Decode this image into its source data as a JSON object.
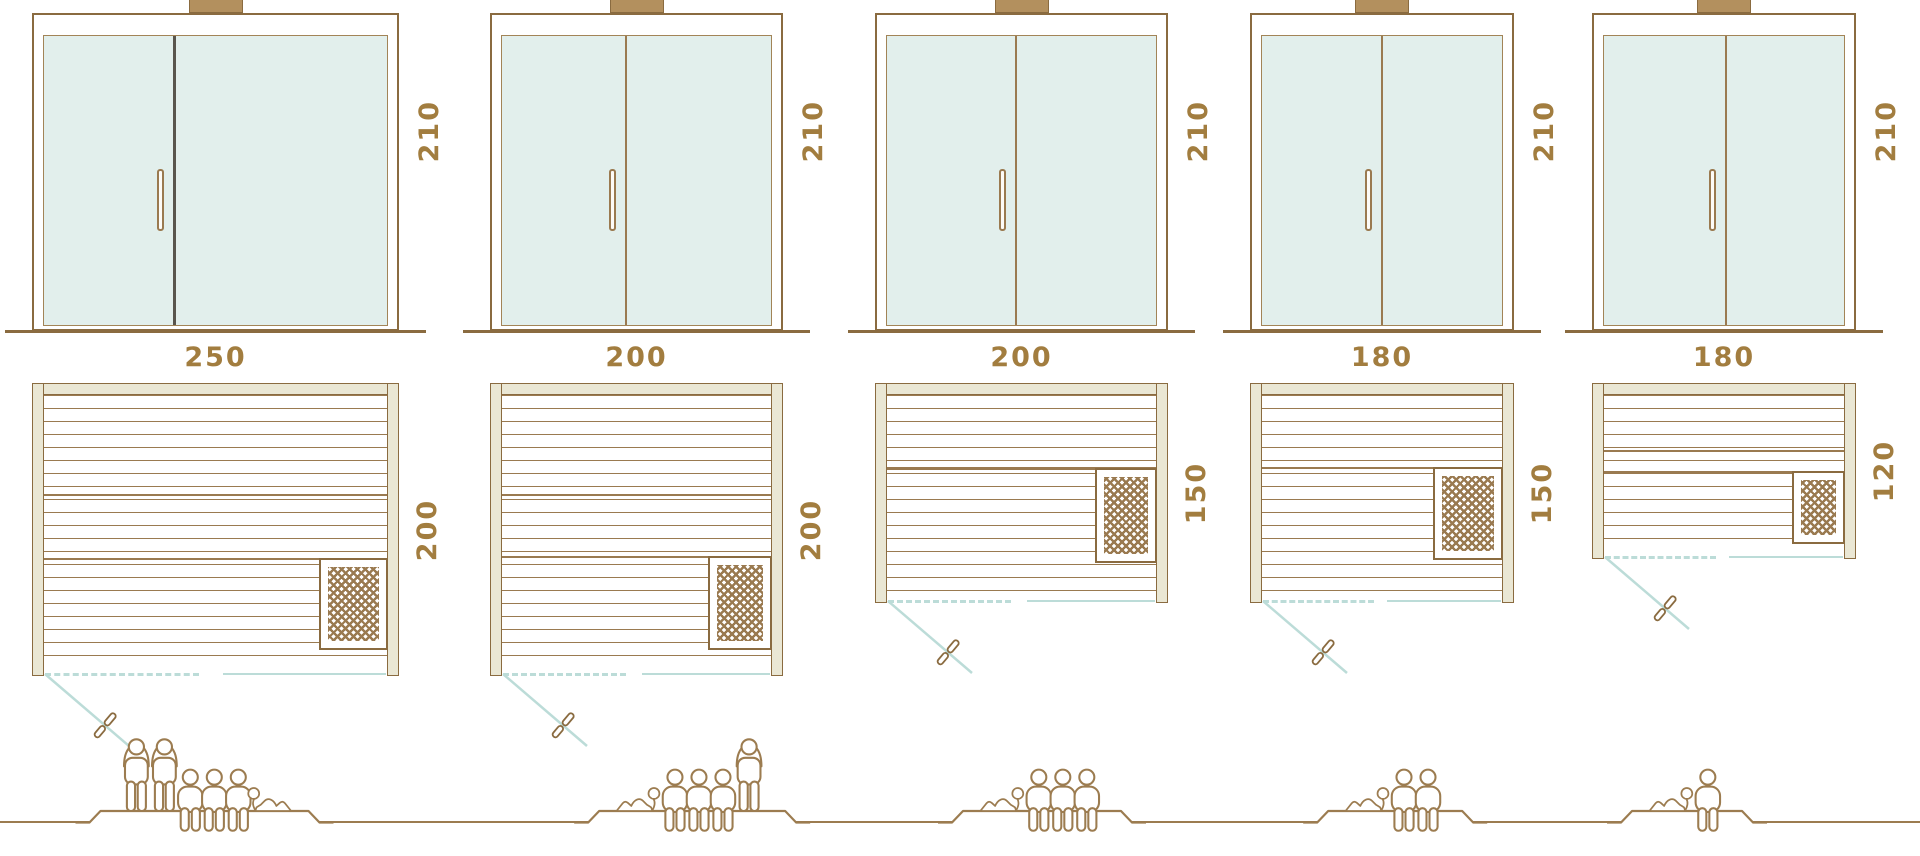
{
  "colors": {
    "line_brown": "#8a6b40",
    "plank_brown": "#9a7a50",
    "wall_fill": "#eae7d4",
    "glass_fill": "#e2efec",
    "swing_blue": "#bcdcd8",
    "dimension_text": "#a27d3f",
    "people_brown": "#9c7c50",
    "door1_divider": "#59554d"
  },
  "icons": {
    "standing": "person-standing-icon",
    "sitting": "person-sitting-icon",
    "lying": "person-lying-icon",
    "door_handle": "door-handle-icon",
    "heater": "heater-grate-icon"
  },
  "saunas": [
    {
      "width_label": "250",
      "depth_label": "200",
      "height_label": "210",
      "width_cm": 250,
      "depth_cm": 200,
      "height_cm": 210,
      "people": [
        "standing",
        "standing",
        "sitting",
        "sitting",
        "sitting",
        "lying"
      ],
      "capacity": {
        "standing": 2,
        "sitting": 3,
        "lying": 1,
        "total": 6
      }
    },
    {
      "width_label": "200",
      "depth_label": "200",
      "height_label": "210",
      "width_cm": 200,
      "depth_cm": 200,
      "height_cm": 210,
      "people": [
        "lying",
        "sitting",
        "sitting",
        "sitting",
        "standing"
      ],
      "capacity": {
        "standing": 1,
        "sitting": 3,
        "lying": 1,
        "total": 5
      }
    },
    {
      "width_label": "200",
      "depth_label": "150",
      "height_label": "210",
      "width_cm": 200,
      "depth_cm": 150,
      "height_cm": 210,
      "people": [
        "lying",
        "sitting",
        "sitting",
        "sitting"
      ],
      "capacity": {
        "standing": 0,
        "sitting": 3,
        "lying": 1,
        "total": 4
      }
    },
    {
      "width_label": "180",
      "depth_label": "150",
      "height_label": "210",
      "width_cm": 180,
      "depth_cm": 150,
      "height_cm": 210,
      "people": [
        "lying",
        "sitting",
        "sitting"
      ],
      "capacity": {
        "standing": 0,
        "sitting": 2,
        "lying": 1,
        "total": 3
      }
    },
    {
      "width_label": "180",
      "depth_label": "120",
      "height_label": "210",
      "width_cm": 180,
      "depth_cm": 120,
      "height_cm": 210,
      "people": [
        "lying",
        "sitting"
      ],
      "capacity": {
        "standing": 0,
        "sitting": 1,
        "lying": 1,
        "total": 2
      }
    }
  ]
}
